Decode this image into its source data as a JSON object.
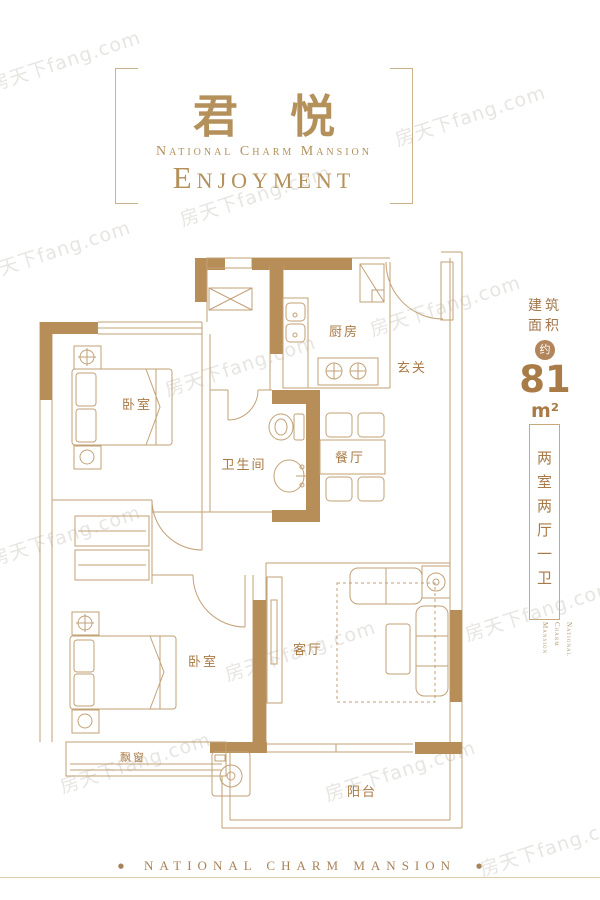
{
  "watermark": {
    "text": "房天下fang.com"
  },
  "header": {
    "title_cn": "君悦",
    "subtitle": "National Charm Mansion",
    "title_en": "Enjoyment"
  },
  "area_info": {
    "label_line1": "建筑",
    "label_line2": "面积",
    "badge": "约",
    "value": "81",
    "unit": "m²",
    "layout": "两室两厅一卫",
    "brand_lines": [
      "National",
      "Charm",
      "Mansion"
    ]
  },
  "floorplan": {
    "rooms": [
      {
        "key": "bedroom-main",
        "label": "卧室"
      },
      {
        "key": "kitchen",
        "label": "厨房"
      },
      {
        "key": "entry",
        "label": "玄关"
      },
      {
        "key": "bathroom",
        "label": "卫生间"
      },
      {
        "key": "dining",
        "label": "餐厅"
      },
      {
        "key": "living",
        "label": "客厅"
      },
      {
        "key": "bedroom-second",
        "label": "卧室"
      },
      {
        "key": "bay-window",
        "label": "飘窗"
      },
      {
        "key": "balcony",
        "label": "阳台"
      }
    ]
  },
  "footer": {
    "brand": "NATIONAL CHARM MANSION",
    "bullet": "●"
  },
  "colors": {
    "gold": "#b4905a",
    "wall_fill": "#b78d58",
    "line": "#c2a176"
  }
}
